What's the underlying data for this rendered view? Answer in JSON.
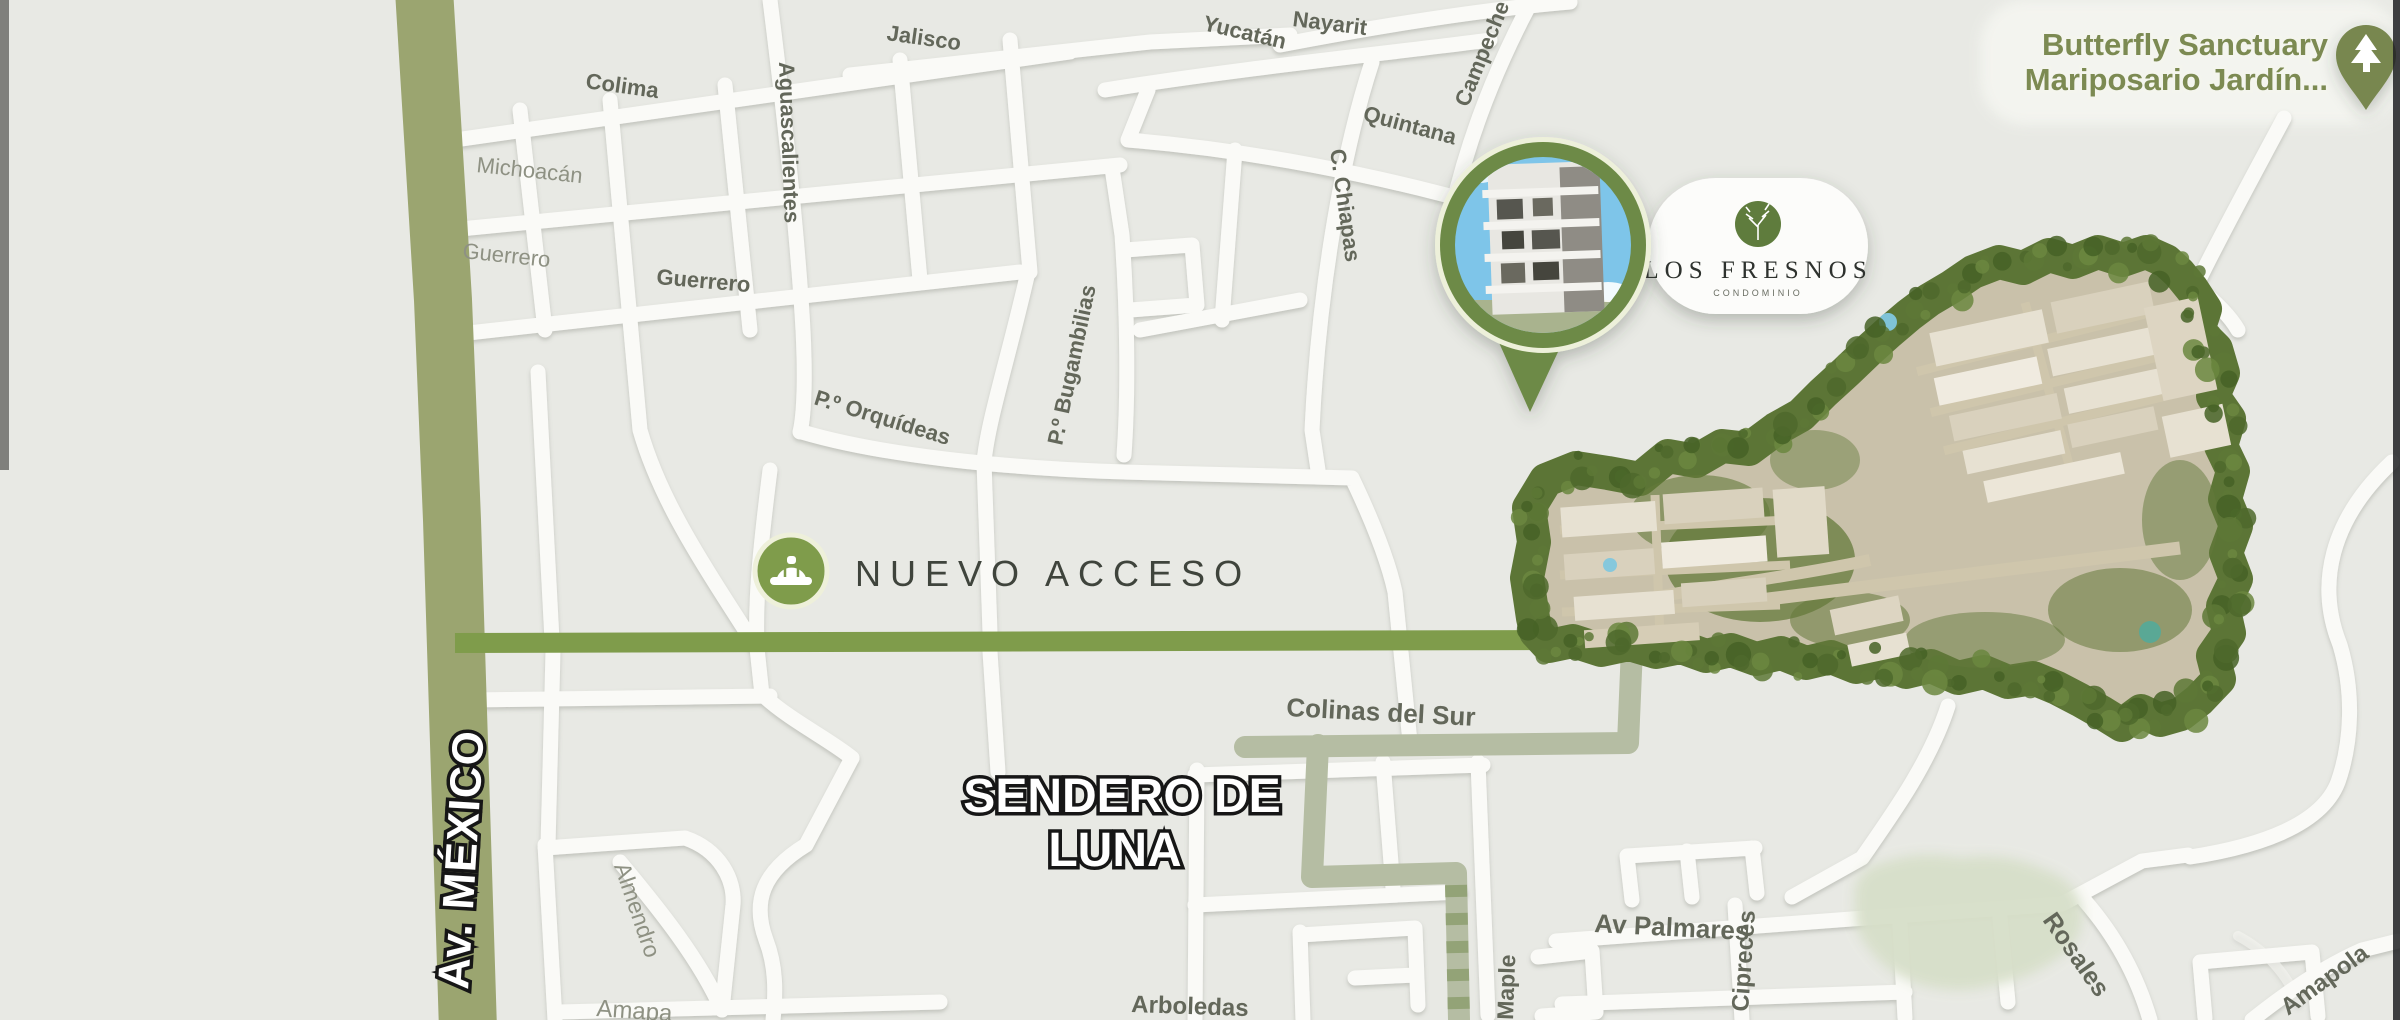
{
  "markers": {
    "los_fresnos": {
      "brand": "LOS FRESNOS",
      "tagline": "CONDOMINIO"
    },
    "butterfly": {
      "line1": "Butterfly Sanctuary",
      "line2": "Mariposario Jardín..."
    }
  },
  "callouts": {
    "nuevo_acceso": "NUEVO ACCESO",
    "av_mexico": "Av. MÉXICO",
    "sendero_de_luna": {
      "line1": "SENDERO DE",
      "line2": "LUNA"
    }
  },
  "streets": [
    {
      "label": "Jalisco"
    },
    {
      "label": "Nayarit"
    },
    {
      "label": "Yucatán"
    },
    {
      "label": "Campeche"
    },
    {
      "label": "Quintana"
    },
    {
      "label": "C. Chiapas"
    },
    {
      "label": "Colima"
    },
    {
      "label": "Michoacán"
    },
    {
      "label": "Guerrero"
    },
    {
      "label": "Guerrero"
    },
    {
      "label": "Aguascalientes"
    },
    {
      "label": "P.º Bugambilias"
    },
    {
      "label": "P.º Orquídeas"
    },
    {
      "label": "Colinas del Sur"
    },
    {
      "label": "Av Palmares"
    },
    {
      "label": "Cipreces"
    },
    {
      "label": "Rosales"
    },
    {
      "label": "Maple"
    },
    {
      "label": "Arboledas"
    },
    {
      "label": "Almendro"
    },
    {
      "label": "Amapa"
    },
    {
      "label": "Amapola"
    }
  ],
  "colors": {
    "background": "#e8e9e4",
    "white_road": "#fafaf7",
    "av_mexico_band": "#9ba570",
    "access_road_green": "#7f9c4b",
    "sage_route": "#b5bda3",
    "site_border_green": "#5c7536",
    "site_fill": "#c9c1aa",
    "brand_green": "#5e7c3c",
    "poi_text_green": "#7c8a52",
    "pin_green": "#78874f",
    "pond_green": "#d7dfc9"
  }
}
